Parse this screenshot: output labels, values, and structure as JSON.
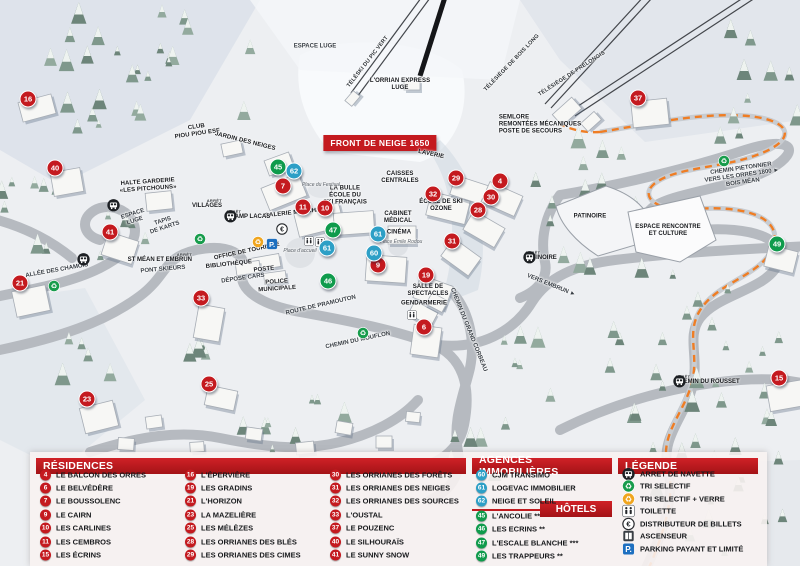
{
  "title_banner": "FRONT DE NEIGE 1650",
  "colors": {
    "residence_red": "#c41a1f",
    "agence_blue": "#2d9fc6",
    "hotel_green": "#0f9b4c",
    "header_red": "#c01b20",
    "orange_path": "#ef7d24",
    "parking_blue": "#1d6fc0"
  },
  "legend_panel": {
    "residences": {
      "header": "RÉSIDENCES",
      "items": [
        {
          "num": "4",
          "name": "LE BALCON DES ORRES"
        },
        {
          "num": "6",
          "name": "LE BELVÉDÈRE"
        },
        {
          "num": "7",
          "name": "LE BOUSSOLENC"
        },
        {
          "num": "9",
          "name": "LE CAIRN"
        },
        {
          "num": "10",
          "name": "LES CARLINES"
        },
        {
          "num": "11",
          "name": "LES CEMBROS"
        },
        {
          "num": "15",
          "name": "LES ÉCRINS"
        },
        {
          "num": "16",
          "name": "L'ÉPERVIÈRE"
        },
        {
          "num": "19",
          "name": "LES GRADINS"
        },
        {
          "num": "21",
          "name": "L'HORIZON"
        },
        {
          "num": "23",
          "name": "LA MAZELIÈRE"
        },
        {
          "num": "25",
          "name": "LES MÉLÈZES"
        },
        {
          "num": "28",
          "name": "LES ORRIANES DES BLÉS"
        },
        {
          "num": "29",
          "name": "LES ORRIANES DES CIMES"
        },
        {
          "num": "30",
          "name": "LES ORRIANES DES FORÊTS"
        },
        {
          "num": "31",
          "name": "LES ORRIANES DES NEIGES"
        },
        {
          "num": "32",
          "name": "LES ORRIANES DES SOURCES"
        },
        {
          "num": "33",
          "name": "L'OUSTAL"
        },
        {
          "num": "37",
          "name": "LE POUZENC"
        },
        {
          "num": "40",
          "name": "LE SILHOURAÏS"
        },
        {
          "num": "41",
          "name": "LE SUNNY SNOW"
        }
      ]
    },
    "agences": {
      "header": "AGENCES IMMOBILIÈRES",
      "items": [
        {
          "num": "60",
          "name": "CJM TRANSIMO"
        },
        {
          "num": "61",
          "name": "LOGEVAC IMMOBILIER"
        },
        {
          "num": "62",
          "name": "NEIGE ET SOLEIL"
        }
      ]
    },
    "hotels": {
      "header": "HÔTELS",
      "items": [
        {
          "num": "45",
          "name": "L'ANCOLIE **"
        },
        {
          "num": "46",
          "name": "LES ECRINS **"
        },
        {
          "num": "47",
          "name": "L'ESCALE BLANCHE ***"
        },
        {
          "num": "49",
          "name": "LES TRAPPEURS **"
        }
      ]
    },
    "legende": {
      "header": "LÉGENDE",
      "items": [
        {
          "icon": "bus-icon",
          "label": "ARRET DE NAVETTE"
        },
        {
          "icon": "recycle-green-icon",
          "label": "TRI SELECTIF"
        },
        {
          "icon": "recycle-yellow-icon",
          "label": "TRI SELECTIF + VERRE"
        },
        {
          "icon": "toilet-icon",
          "label": "TOILETTE"
        },
        {
          "icon": "atm-icon",
          "label": "DISTRIBUTEUR DE BILLETS"
        },
        {
          "icon": "elevator-icon",
          "label": "ASCENSEUR"
        },
        {
          "icon": "parking-icon",
          "label": "PARKING PAYANT ET LIMITÉ"
        }
      ]
    }
  },
  "map": {
    "bus_stop_prefix": "ARRÊT",
    "markers": [
      {
        "type": "residence",
        "num": "16",
        "x": 28,
        "y": 99
      },
      {
        "type": "residence",
        "num": "40",
        "x": 55,
        "y": 168
      },
      {
        "type": "residence",
        "num": "41",
        "x": 110,
        "y": 232
      },
      {
        "type": "residence",
        "num": "21",
        "x": 20,
        "y": 283
      },
      {
        "type": "residence",
        "num": "33",
        "x": 201,
        "y": 298
      },
      {
        "type": "residence",
        "num": "23",
        "x": 87,
        "y": 399
      },
      {
        "type": "residence",
        "num": "25",
        "x": 209,
        "y": 384
      },
      {
        "type": "residence",
        "num": "37",
        "x": 638,
        "y": 98
      },
      {
        "type": "residence",
        "num": "15",
        "x": 779,
        "y": 378
      },
      {
        "type": "residence",
        "num": "7",
        "x": 283,
        "y": 186
      },
      {
        "type": "residence",
        "num": "11",
        "x": 303,
        "y": 207
      },
      {
        "type": "residence",
        "num": "10",
        "x": 325,
        "y": 208
      },
      {
        "type": "residence",
        "num": "9",
        "x": 378,
        "y": 265
      },
      {
        "type": "residence",
        "num": "29",
        "x": 456,
        "y": 178
      },
      {
        "type": "residence",
        "num": "32",
        "x": 433,
        "y": 194
      },
      {
        "type": "residence",
        "num": "4",
        "x": 500,
        "y": 181
      },
      {
        "type": "residence",
        "num": "30",
        "x": 491,
        "y": 197
      },
      {
        "type": "residence",
        "num": "28",
        "x": 478,
        "y": 210
      },
      {
        "type": "residence",
        "num": "31",
        "x": 452,
        "y": 241
      },
      {
        "type": "residence",
        "num": "19",
        "x": 426,
        "y": 275
      },
      {
        "type": "residence",
        "num": "6",
        "x": 424,
        "y": 327
      },
      {
        "type": "hotel",
        "num": "45",
        "x": 278,
        "y": 167
      },
      {
        "type": "hotel",
        "num": "47",
        "x": 333,
        "y": 230
      },
      {
        "type": "hotel",
        "num": "46",
        "x": 328,
        "y": 281
      },
      {
        "type": "hotel",
        "num": "49",
        "x": 777,
        "y": 244
      },
      {
        "type": "agence",
        "num": "62",
        "x": 294,
        "y": 171
      },
      {
        "type": "agence",
        "num": "61",
        "x": 327,
        "y": 248
      },
      {
        "type": "agence",
        "num": "61",
        "x": 378,
        "y": 234
      },
      {
        "type": "agence",
        "num": "60",
        "x": 374,
        "y": 253
      }
    ],
    "labels": [
      {
        "cls": "place",
        "x": 197,
        "y": 131,
        "r": -8,
        "lines": [
          "CLUB",
          "PIOU PIOU ESF"
        ]
      },
      {
        "cls": "place",
        "x": 245,
        "y": 142,
        "r": 14,
        "lines": [
          "JARDIN DES NEIGES"
        ]
      },
      {
        "cls": "place",
        "x": 148,
        "y": 186,
        "r": -4,
        "lines": [
          "HALTE GARDERIE",
          "«LES PITCHOUNS»"
        ]
      },
      {
        "cls": "place",
        "x": 345,
        "y": 196,
        "r": 0,
        "lines": [
          "LA BULLE",
          "ÉCOLE DU",
          "SKI FRANÇAIS"
        ]
      },
      {
        "cls": "place",
        "x": 299,
        "y": 213,
        "r": -6,
        "lines": [
          "GALERIE MARCHANDE"
        ]
      },
      {
        "cls": "place",
        "x": 400,
        "y": 178,
        "r": 0,
        "lines": [
          "CAISSES",
          "CENTRALES"
        ]
      },
      {
        "cls": "place",
        "x": 441,
        "y": 206,
        "r": 0,
        "lines": [
          "ÉCOLE DE SKI",
          "OZONE"
        ]
      },
      {
        "cls": "place",
        "x": 398,
        "y": 218,
        "r": 0,
        "lines": [
          "CABINET",
          "MÉDICAL"
        ]
      },
      {
        "cls": "place",
        "x": 399,
        "y": 233,
        "r": 0,
        "lines": [
          "CINÉMA"
        ]
      },
      {
        "cls": "place",
        "x": 431,
        "y": 155,
        "r": 12,
        "lines": [
          "LAVERIE"
        ]
      },
      {
        "cls": "place",
        "x": 229,
        "y": 265,
        "r": -6,
        "lines": [
          "BIBLIOTHÈQUE"
        ]
      },
      {
        "cls": "place",
        "x": 264,
        "y": 270,
        "r": -6,
        "lines": [
          "POSTE"
        ]
      },
      {
        "cls": "place",
        "x": 277,
        "y": 286,
        "r": -4,
        "lines": [
          "POLICE",
          "MUNICIPALE"
        ]
      },
      {
        "cls": "place",
        "x": 247,
        "y": 252,
        "r": -12,
        "lines": [
          "OFFICE DE TOURISME"
        ]
      },
      {
        "cls": "road",
        "x": 243,
        "y": 279,
        "r": -8,
        "lines": [
          "DÉPOSE CARS"
        ]
      },
      {
        "cls": "road",
        "x": 163,
        "y": 270,
        "r": -5,
        "lines": [
          "PONT SKIEURS"
        ]
      },
      {
        "cls": "place",
        "x": 424,
        "y": 304,
        "r": 0,
        "lines": [
          "GENDARMERIE"
        ]
      },
      {
        "cls": "place",
        "x": 428,
        "y": 291,
        "r": 0,
        "lines": [
          "SALLE DE",
          "SPECTACLES"
        ]
      },
      {
        "cls": "place",
        "x": 590,
        "y": 217,
        "r": 0,
        "lines": [
          "PATINOIRE"
        ]
      },
      {
        "cls": "place",
        "x": 668,
        "y": 231,
        "r": 0,
        "lines": [
          "ESPACE RENCONTRE",
          "ET CULTURE"
        ]
      },
      {
        "cls": "place leftalign",
        "x": 540,
        "y": 125,
        "r": 0,
        "lines": [
          "SEMLORE",
          "REMONTÉES MÉCANIQUES",
          "POSTE DE SECOURS"
        ]
      },
      {
        "cls": "place",
        "x": 400,
        "y": 85,
        "r": 0,
        "lines": [
          "L'ORRIAN EXPRESS",
          "LUGE"
        ]
      },
      {
        "cls": "road",
        "x": 57,
        "y": 271,
        "r": -10,
        "lines": [
          "ALLÉE DES CHAMOIS"
        ]
      },
      {
        "cls": "road",
        "x": 321,
        "y": 306,
        "r": -13,
        "lines": [
          "ROUTE DE PRAMOUTON"
        ]
      },
      {
        "cls": "road",
        "x": 358,
        "y": 341,
        "r": -12,
        "lines": [
          "CHEMIN DU MOUFLON"
        ]
      },
      {
        "cls": "road",
        "x": 468,
        "y": 330,
        "r": 68,
        "lines": [
          "CHEMIN DU GRAND CORBEAU"
        ]
      },
      {
        "cls": "road",
        "x": 551,
        "y": 286,
        "r": 22,
        "lines": [
          "VERS EMBRUN ►"
        ]
      },
      {
        "cls": "road",
        "x": 742,
        "y": 176,
        "r": -8,
        "lines": [
          "CHEMIN PIETONNIER",
          "VERS LES ORRES 1800 ►",
          "BOIS MÉAN"
        ]
      },
      {
        "cls": "road",
        "x": 134,
        "y": 218,
        "r": -18,
        "lines": [
          "ESPACE",
          "LUGE"
        ]
      },
      {
        "cls": "road",
        "x": 164,
        "y": 225,
        "r": -18,
        "lines": [
          "TAPIS",
          "DE KARTS"
        ]
      },
      {
        "cls": "road",
        "x": 315,
        "y": 47,
        "r": 0,
        "lines": [
          "ESPACE LUGE"
        ]
      },
      {
        "cls": "lift",
        "x": 368,
        "y": 62,
        "r": -52,
        "lines": [
          "TÉLÉSKI DU PIC VERT"
        ]
      },
      {
        "cls": "lift",
        "x": 512,
        "y": 63,
        "r": -46,
        "lines": [
          "TÉLÉSIÈGE DE BOIS LONG"
        ]
      },
      {
        "cls": "lift",
        "x": 572,
        "y": 74,
        "r": -33,
        "lines": [
          "TÉLÉSIÈGE DE PRÉLONGIS"
        ]
      },
      {
        "cls": "plaza",
        "x": 321,
        "y": 186,
        "r": 0,
        "lines": [
          "Place du Festival"
        ]
      },
      {
        "cls": "plaza",
        "x": 300,
        "y": 252,
        "r": 0,
        "lines": [
          "Place d'accueil"
        ]
      },
      {
        "cls": "plaza",
        "x": 401,
        "y": 243,
        "r": 0,
        "lines": [
          "Place Émile Rodou"
        ]
      }
    ],
    "bus_stops": [
      {
        "name": "VILLAGES",
        "x": 217,
        "y": 204,
        "side": "left"
      },
      {
        "name": "CHAMP LACAS",
        "x": 231,
        "y": 215,
        "side": "right"
      },
      {
        "name": "ST MÉAN ET EMBRUN",
        "x": 187,
        "y": 258,
        "side": "left"
      },
      {
        "name": "PATINOIRE",
        "x": 530,
        "y": 256,
        "side": "right"
      },
      {
        "name": "CHEMIN DU ROUSSET",
        "x": 680,
        "y": 380,
        "side": "right"
      }
    ],
    "icons": [
      {
        "type": "recycle-green",
        "x": 48,
        "y": 280
      },
      {
        "type": "recycle-green",
        "x": 194,
        "y": 233
      },
      {
        "type": "recycle-green",
        "x": 357,
        "y": 327
      },
      {
        "type": "recycle-green",
        "x": 718,
        "y": 155
      },
      {
        "type": "recycle-yellow",
        "x": 252,
        "y": 236
      },
      {
        "type": "parking",
        "x": 266,
        "y": 238
      },
      {
        "type": "atm",
        "x": 276,
        "y": 223
      },
      {
        "type": "toilet",
        "x": 304,
        "y": 236
      },
      {
        "type": "toilet",
        "x": 315,
        "y": 237
      },
      {
        "type": "toilet",
        "x": 407,
        "y": 310
      }
    ]
  }
}
